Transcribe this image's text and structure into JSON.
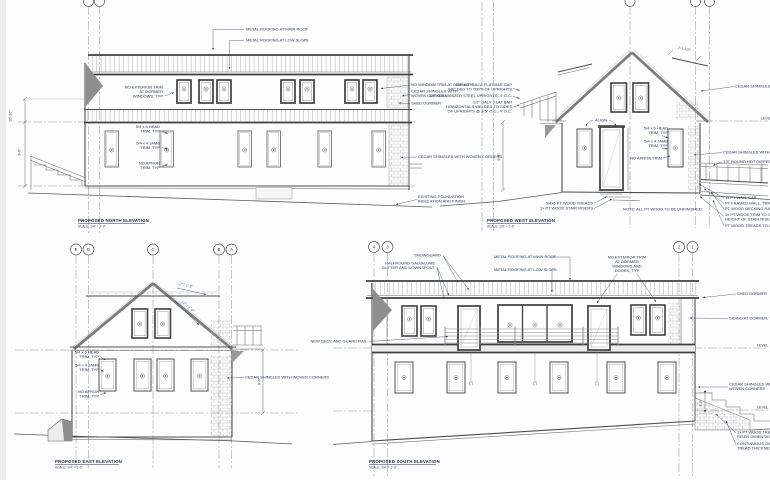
{
  "sheet": {
    "type": "architectural elevation drawings",
    "colors": {
      "paper": "#fdfdfd",
      "ink": "#5a5a5a",
      "annotation": "#26334f",
      "slope_accent": "#4a68ad",
      "hatch": "#b6b6b6",
      "shadow": "#8e8e8e"
    }
  },
  "north": {
    "title": "PROPOSED NORTH ELEVATION",
    "scale": "SCALE: 1/4\" = 1'-0\"",
    "dims": {
      "overall": "20'-10\"",
      "floor": "9'-6\""
    },
    "labels": {
      "metal_main": "METAL ROOFING AT MAIN ROOF",
      "metal_low": "METAL ROOFING AT LOW SLOPE",
      "no_ext_trim": [
        "NO EXTERIOR TRIM",
        "AT DORMER",
        "WINDOWS, TYP"
      ],
      "head_trim": [
        "5/4 x 6 HEAD",
        "TRIM, TYP"
      ],
      "jamb_trim": [
        "5/4 x 4 JAMB",
        "TRIM, TYP"
      ],
      "no_apron": [
        "NO APRON",
        "TRIM, TYP"
      ],
      "no_window_trim": "NO WINDOW TRIM AT DORMERS",
      "cedar_corner": [
        "CEDAR SHINGLES WITH",
        "WOVEN CORNERS"
      ],
      "shed_dormer": "SHED DORMER",
      "cedar_wall": "CEDAR SHINGLES WITH WOVEN CORNERS",
      "foundation": [
        "EXISTING FOUNDATION",
        "INSULATION AND FINISH"
      ]
    }
  },
  "west": {
    "title": "PROPOSED WEST ELEVATION",
    "scale": "SCALE: 1/4\" = 1'-0\"",
    "dims": {
      "overhang": "2'-1 1/2\"",
      "floor": "9'-6\""
    },
    "labels": {
      "rail_cap": [
        "3/4\" x 3\" GALV. FLAT BAR CAP",
        "WELDED TO TOPS OF UPRIGHTS"
      ],
      "rail_uprights": "3/4\" GALVANIZED STEEL UPRIGHTS, 4' O.C.",
      "rail_horizontals": [
        "1/2\" GALV. FLAT BAR",
        "HORIZONTALS WELDED TO SIDES",
        "OF UPRIGHTS @ 3.5\" O.C., 4' O.C."
      ],
      "align": "ALIGN",
      "head_trim": [
        "5/4 x 6 HEAD",
        "TRIM, TYP"
      ],
      "jamb_trim": [
        "5/4 x 4 JAMB",
        "TRIM, TYP"
      ],
      "no_apron": "NO APRON TRIM",
      "cedar_upper": "CEDAR SHINGLES WITH WOVEN CORNERS",
      "level": "LEVEL",
      "cedar_lower": "CEDAR SHINGLES WITH WOVEN CORNERS",
      "handrail": "1.5\" ROUND HOT DIPPED GALV.",
      "wall_cap": "1x PT WALL CAP",
      "framed_wall": "PT FRAMED WALL, TRIMED WITH",
      "decking": "PT WOOD DECKING RAMP BEYOND",
      "riser_trim": [
        "1x PT WOOD TRIM TO CONTINUE",
        "HEIGHT OF STAIR RISER"
      ],
      "treads_continue": "PT WOOD TREADS TO CONTINUE",
      "treads": "5/4x6 PT WOOD TREADS",
      "risers": "1x PT WOOD STAIR RISERS",
      "note": "NOTE: ALL PT WOOD TO BE UNFINISHED"
    }
  },
  "east": {
    "title": "PROPOSED EAST ELEVATION",
    "scale": "SCALE: 1/4\" = 1'-0\"",
    "grid": [
      "E",
      "D",
      "C",
      "B",
      "A"
    ],
    "dims": {
      "floor": "9'-6\""
    },
    "slopes": {
      "low": "2\" / 1'-0\"",
      "steep": "12\" / 1'-0\""
    },
    "labels": {
      "head_trim": [
        "5/4 x 6 HEAD",
        "TRIM, TYP"
      ],
      "jamb_trim": [
        "5/4 x 4 JAMB",
        "TRIM, TYP"
      ],
      "no_apron": [
        "NO APRON",
        "TRIM, TYP"
      ],
      "cedar": "CEDAR SHINGLES WITH WOVEN CORNERS"
    }
  },
  "south": {
    "title": "PROPOSED SOUTH ELEVATION",
    "scale": "SCALE: 1/4\" = 1'-0\"",
    "grid_left": [
      "4",
      "3"
    ],
    "grid_right": [
      "2",
      "1"
    ],
    "dims": {
      "stair": "3'-0\""
    },
    "labels": {
      "snowguard": "SNOWGUARD",
      "gutter": [
        "HALFROUND GALVALUME",
        "GUTTER AND DOWNSPOUT"
      ],
      "metal_main": "METAL ROOFING AT MAIN ROOF",
      "metal_low": "METAL ROOFING AT LOW SLOPE",
      "no_ext_trim": [
        "NO EXTERIOR TRIM",
        "AT DORMER",
        "WINDOWS AND",
        "DOORS, TYP"
      ],
      "shed_dormer": "SHED DORMER",
      "siding": "SIDING AT DORMER, TBD",
      "level_upper": "LEVEL",
      "level_lower": "LEVEL",
      "cedar": [
        "CEDAR SHINGLES WITH",
        "WOVEN CORNERS"
      ],
      "new_deck": "NEW DECK AND GUARD RAIL",
      "treads": [
        "1x PT WOOD TREADS,",
        "RISER DIMENSION TBD"
      ],
      "tread_thickness": [
        "CONTINUOUS GALV.",
        "TREAD THICKNESS"
      ]
    }
  }
}
